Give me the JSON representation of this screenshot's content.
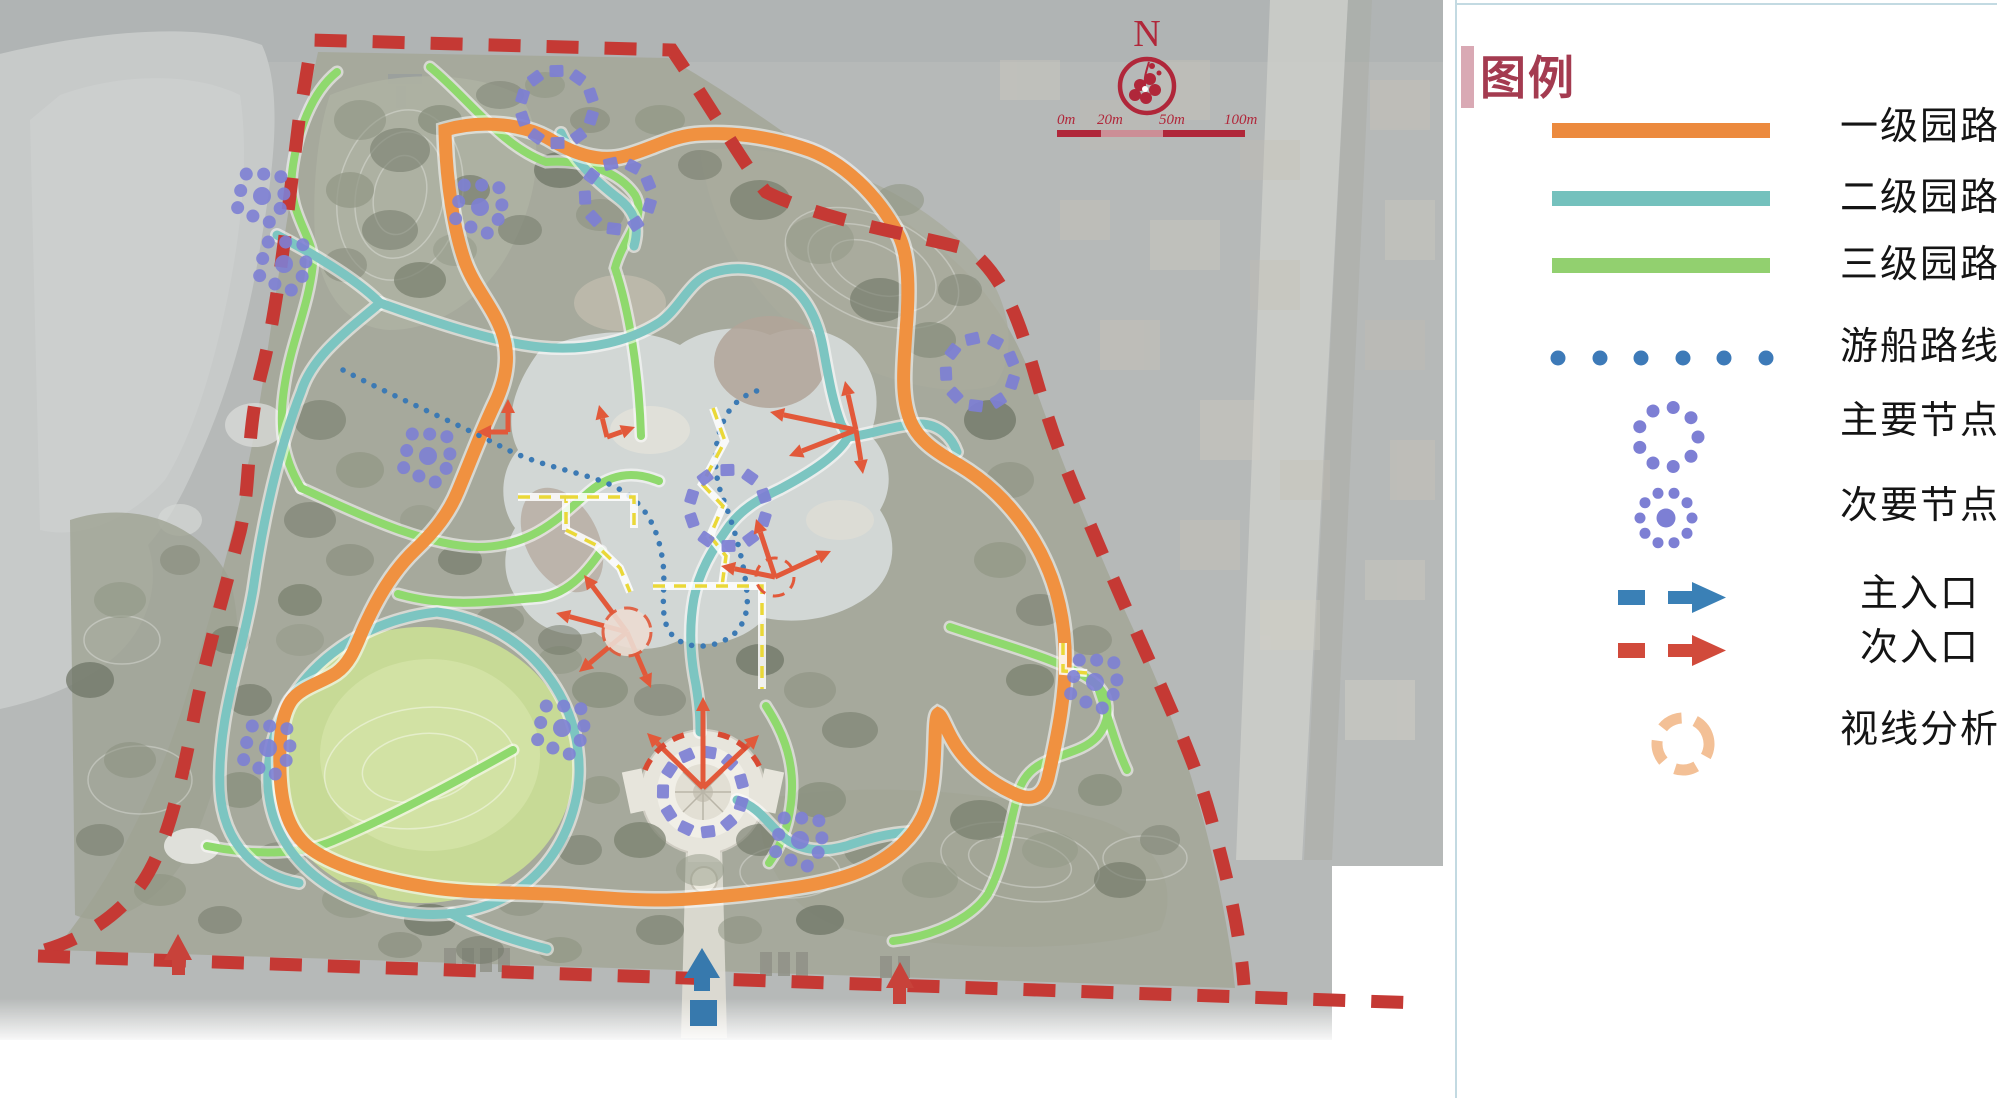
{
  "legend": {
    "title": "图例",
    "title_color": "#A43B50",
    "accent_bar_color": "#D9A9B4",
    "items": [
      {
        "id": "primary-road",
        "label": "一级园路",
        "swatch": "bar",
        "color": "#EC8A3E"
      },
      {
        "id": "secondary-road",
        "label": "二级园路",
        "swatch": "bar",
        "color": "#74C1BD"
      },
      {
        "id": "tertiary-road",
        "label": "三级园路",
        "swatch": "bar",
        "color": "#92D06F"
      },
      {
        "id": "boat-route",
        "label": "游船路线",
        "swatch": "dots",
        "color": "#3D7AB8"
      },
      {
        "id": "main-node",
        "label": "主要节点",
        "swatch": "dot-ring",
        "color": "#7D7FD4"
      },
      {
        "id": "secondary-node",
        "label": "次要节点",
        "swatch": "dot-ring-center",
        "color": "#7D7FD4"
      },
      {
        "id": "main-entrance",
        "label": "主入口",
        "swatch": "dash-arrow",
        "color": "#3A80B6"
      },
      {
        "id": "secondary-entrance",
        "label": "次入口",
        "swatch": "dash-arrow",
        "color": "#D14A3B"
      },
      {
        "id": "sightline-analysis",
        "label": "视线分析",
        "swatch": "dashed-circle",
        "color": "#F3C096"
      }
    ]
  },
  "map": {
    "compass": {
      "label": "N",
      "color": "#B0273A"
    },
    "scale_bar": {
      "labels": [
        "0m",
        "20m",
        "50m",
        "100m"
      ],
      "color": "#B0273A",
      "mid_color": "#CC8E96"
    },
    "boundary_color": "#C53934",
    "road_colors": {
      "primary": "#F09140",
      "secondary": "#7CC5C1",
      "tertiary": "#8FD96D"
    },
    "boat_route_color": "#3C7AB4",
    "node_color": "#7D7FD4",
    "sightline_color": "#E2593A",
    "sight_guide_color": "#EAD838",
    "entrance_colors": {
      "main": "#3779AD",
      "secondary": "#C8423A"
    }
  }
}
